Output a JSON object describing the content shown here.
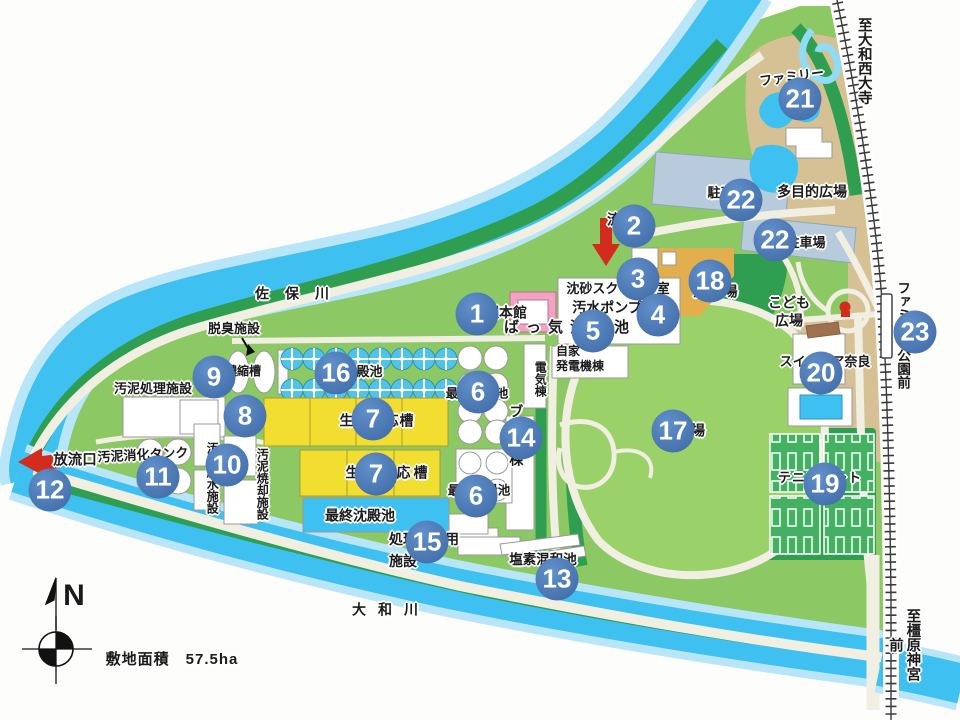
{
  "map": {
    "compass_north": "N",
    "site_area": "敷地面積　57.5ha",
    "rivers": {
      "north": "佐保川",
      "south": "大和川"
    },
    "railway": {
      "to_north": "至大和西大寺",
      "station": "ファミリー公園前",
      "to_south": "至橿原神宮前"
    },
    "colors": {
      "marker_blue": "#4a77b4",
      "river_blue": "#3ec1f0",
      "land_green": "#8cc863",
      "tank_yellow": "#f2de30",
      "arrow_red": "#d32b1e"
    },
    "labels": [
      {
        "id": "dasshu-shisetsu",
        "text": "脱臭施設",
        "x": 234,
        "y": 329,
        "size": 13
      },
      {
        "id": "odei-shori-shisetsu",
        "text": "汚泥処理施設",
        "x": 153,
        "y": 389,
        "size": 13
      },
      {
        "id": "noshukuso",
        "text": "濃縮槽",
        "x": 243,
        "y": 371,
        "size": 12
      },
      {
        "id": "saishu-chindenchi-tanks",
        "text": "最終沈殿池",
        "x": 350,
        "y": 372,
        "size": 13
      },
      {
        "id": "seibutsu-hannoso-1",
        "text": "生物反応槽",
        "x": 377,
        "y": 421,
        "size": 14,
        "ls": 1
      },
      {
        "id": "seibutsu-hannoso-2",
        "text": "生物反応槽",
        "x": 388,
        "y": 473,
        "size": 14,
        "ls": 3
      },
      {
        "id": "saishu-chindenchi-pool",
        "text": "最終沈殿池",
        "x": 360,
        "y": 516,
        "size": 14
      },
      {
        "id": "saisho-chindenchi-1",
        "text": "最初沈殿池",
        "x": 477,
        "y": 394,
        "size": 12.5
      },
      {
        "id": "saisho-chindenchi-2",
        "text": "最初沈殿池",
        "x": 479,
        "y": 491,
        "size": 12.5
      },
      {
        "id": "kanri-honkan",
        "text": "管理本館",
        "x": 499,
        "y": 313,
        "size": 14
      },
      {
        "id": "chinsa-screen-shitsu",
        "text": "沈砂スクリーン室",
        "x": 618,
        "y": 289,
        "size": 13
      },
      {
        "id": "osui-pump",
        "text": "汚水ポンプ",
        "x": 607,
        "y": 308,
        "size": 14
      },
      {
        "id": "bakki-chinsachi",
        "text": "ばっ気沈砂池",
        "x": 570,
        "y": 328,
        "size": 15,
        "ls": 7
      },
      {
        "id": "ryunyuko",
        "text": "流入口",
        "x": 628,
        "y": 220,
        "size": 14
      },
      {
        "id": "denki-to",
        "text": "電気棟",
        "x": 540,
        "y": 379,
        "size": 12,
        "v": true
      },
      {
        "id": "jika-hatsudenki-to",
        "text": "自家\n発電機棟",
        "x": 556,
        "y": 344,
        "size": 12,
        "anchor": "lt",
        "lh": 1.25
      },
      {
        "id": "blower-to",
        "text": "ブロワ棟",
        "x": 516,
        "y": 436,
        "size": 14,
        "v": true,
        "ls": 2
      },
      {
        "id": "shorisui-riyo-shisetsu",
        "text": "処理水利用\n施設",
        "x": 389,
        "y": 529,
        "size": 14,
        "anchor": "lt",
        "lh": 1.55
      },
      {
        "id": "enso-konwachi",
        "text": "塩素混和池",
        "x": 543,
        "y": 560,
        "size": 13.5
      },
      {
        "id": "odei-shoka-tank",
        "text": "汚泥消化タンク",
        "x": 143,
        "y": 455,
        "size": 13,
        "rot": -3
      },
      {
        "id": "odei-dassui-shisetsu",
        "text": "汚泥脱水施設",
        "x": 212,
        "y": 478,
        "size": 12,
        "v": true
      },
      {
        "id": "odei-shokyaku-shisetsu",
        "text": "汚泥焼却施設",
        "x": 262,
        "y": 484,
        "size": 12,
        "v": true
      },
      {
        "id": "horyuko",
        "text": "放流口",
        "x": 75,
        "y": 461,
        "size": 14.5
      },
      {
        "id": "parking-1",
        "text": "駐車場",
        "x": 727,
        "y": 193,
        "size": 13
      },
      {
        "id": "parking-2",
        "text": "駐車場",
        "x": 806,
        "y": 243,
        "size": 13
      },
      {
        "id": "tamokuteki-hiroba",
        "text": "多目的広場",
        "x": 812,
        "y": 192,
        "size": 14
      },
      {
        "id": "kodomo-hiroba",
        "text": "こども\n広場",
        "x": 789,
        "y": 312,
        "size": 14,
        "lh": 1.25
      },
      {
        "id": "yakyujo",
        "text": "野球場",
        "x": 716,
        "y": 292,
        "size": 14,
        "ls": 1
      },
      {
        "id": "hiroba",
        "text": "広場",
        "x": 691,
        "y": 431,
        "size": 14
      },
      {
        "id": "swimpia-nara",
        "text": "スイムピア奈良",
        "x": 825,
        "y": 362,
        "size": 13
      },
      {
        "id": "tennis-court",
        "text": "テニスコート",
        "x": 820,
        "y": 478,
        "size": 13,
        "ls": 1
      },
      {
        "id": "family-ike",
        "text": "ファミリー\n池",
        "x": 793,
        "y": 86,
        "size": 13,
        "rot": -8,
        "lh": 1.3
      }
    ],
    "markers": [
      {
        "n": 1,
        "x": 477,
        "y": 314
      },
      {
        "n": 2,
        "x": 634,
        "y": 226
      },
      {
        "n": 3,
        "x": 638,
        "y": 279
      },
      {
        "n": 4,
        "x": 658,
        "y": 315
      },
      {
        "n": 5,
        "x": 593,
        "y": 331
      },
      {
        "n": 6,
        "x": 478,
        "y": 392
      },
      {
        "n": 6,
        "x": 476,
        "y": 496
      },
      {
        "n": 7,
        "x": 373,
        "y": 419
      },
      {
        "n": 7,
        "x": 376,
        "y": 474
      },
      {
        "n": 8,
        "x": 245,
        "y": 416
      },
      {
        "n": 9,
        "x": 214,
        "y": 377
      },
      {
        "n": 10,
        "x": 227,
        "y": 465
      },
      {
        "n": 11,
        "x": 158,
        "y": 477
      },
      {
        "n": 12,
        "x": 50,
        "y": 490
      },
      {
        "n": 13,
        "x": 557,
        "y": 579
      },
      {
        "n": 14,
        "x": 521,
        "y": 438
      },
      {
        "n": 15,
        "x": 427,
        "y": 542
      },
      {
        "n": 16,
        "x": 336,
        "y": 373
      },
      {
        "n": 17,
        "x": 673,
        "y": 431
      },
      {
        "n": 18,
        "x": 710,
        "y": 281
      },
      {
        "n": 19,
        "x": 825,
        "y": 484
      },
      {
        "n": 20,
        "x": 821,
        "y": 373
      },
      {
        "n": 21,
        "x": 800,
        "y": 99
      },
      {
        "n": 22,
        "x": 741,
        "y": 200
      },
      {
        "n": 22,
        "x": 775,
        "y": 240
      },
      {
        "n": 23,
        "x": 915,
        "y": 332
      }
    ]
  }
}
